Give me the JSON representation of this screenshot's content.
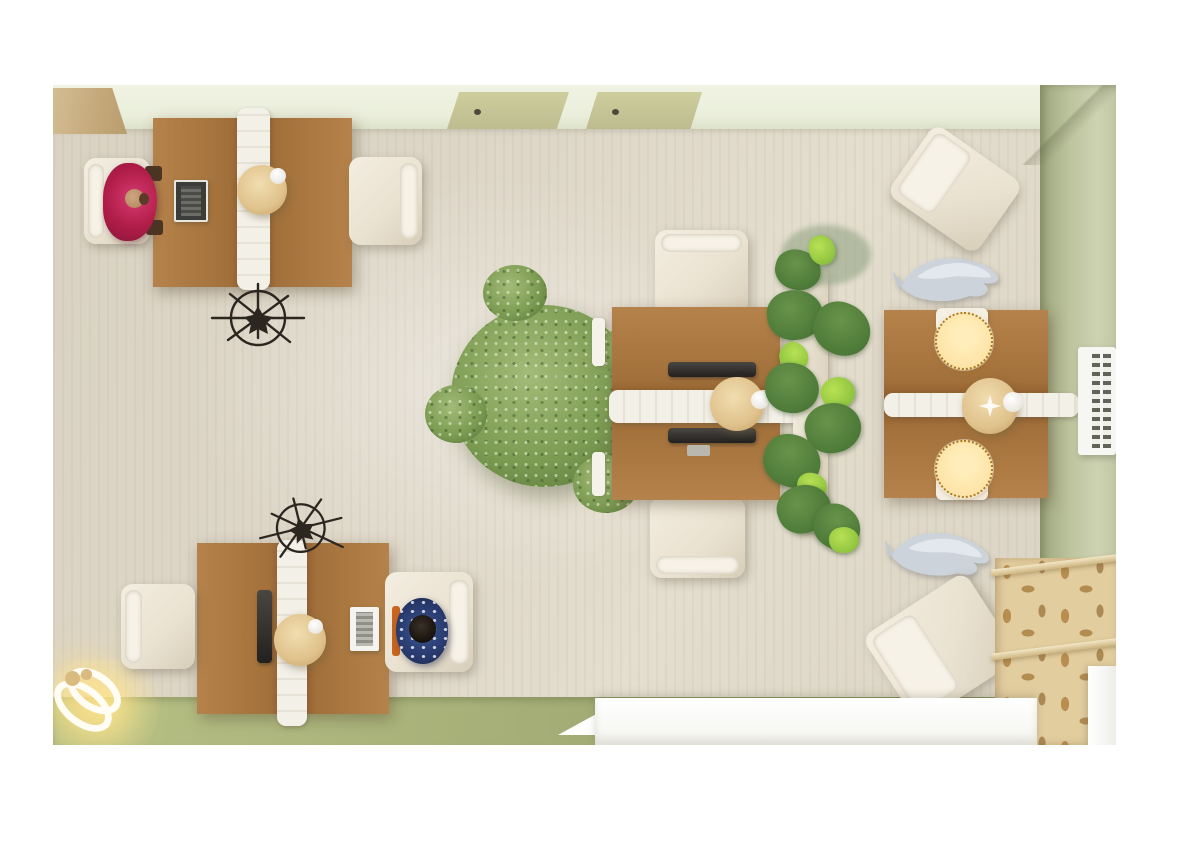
{
  "scene": {
    "type": "3d-interior-render",
    "view": "top-down",
    "title": "Open-plan office floor view",
    "rooms": "single room with beige wood floor, mint top wall, olive right wall and green lower floor strip"
  },
  "colors": {
    "floor": "#ded7c8",
    "wall_top": "#eaeedb",
    "wall_right": "#bdc49e",
    "floor_green": "#a4ae76",
    "desk_wood": "#b5824b",
    "desk_wood_dark": "#8a5828",
    "divider_white": "#f3f0e8",
    "chair_cream": "#e9e1d0",
    "lamp_beige": "#e0c28c",
    "plant_green": "#7d9c53",
    "monstera_green": "#4e7a39",
    "person_red": "#b01d48",
    "person_navy": "#27386b",
    "fish_silver": "#ccd3da",
    "bench_tan": "#e2cd9f",
    "bench_motif": "#b78e4f",
    "counter_white": "#f4f4ef",
    "hotspot_fill": "#fee3a5",
    "hotspot_border": "#a87b25",
    "glow": "#ffe9a8"
  },
  "hotspots": {
    "description": "two highlighted available-seat markers on the right workstation",
    "items": [
      {
        "id": "seat-hotspot-top",
        "shape": "dashed-circle"
      },
      {
        "id": "seat-hotspot-bottom",
        "shape": "dashed-circle"
      }
    ]
  },
  "objects": [
    "workstation-desk-top-left with laptop, sphere lamp, seated person in red",
    "workstation-desk-bottom-left with laptops, sphere lamp, seated person in navy",
    "workstation-desk-center with monitors and sphere lamp",
    "workstation-desk-right with sphere lamp and two seat hotspots",
    "wireframe-fan-sculpture x2",
    "potted-tree large",
    "monstera-planter divider",
    "silver-fish-sculpture x2",
    "radiator-vent on right wall",
    "patterned-lounge-bench bottom-right",
    "reception-counter white",
    "glowing-ring-floor-lamp bottom-left",
    "cream-office-chairs x8",
    "wall-door-panels x2 on top wall",
    "wood-mat top-left corner"
  ]
}
